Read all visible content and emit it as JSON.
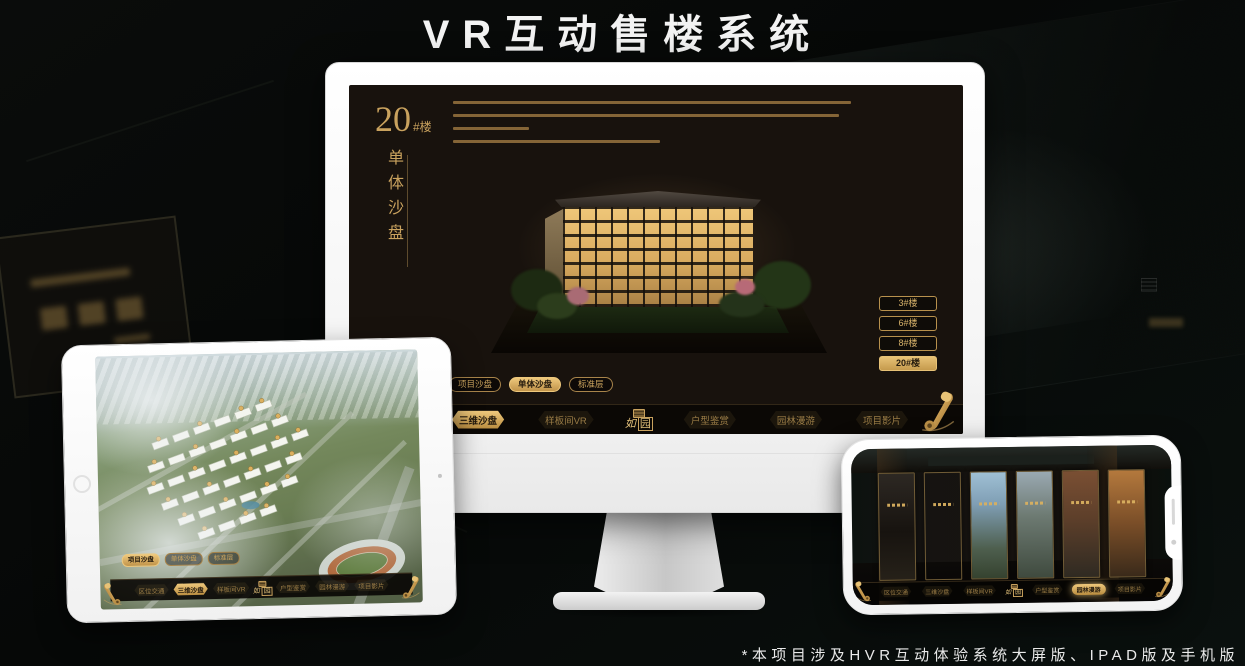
{
  "page": {
    "title": "VR互动售楼系统",
    "footnote": "*本项目涉及HVR互动体验系统大屏版、IPAD版及手机版"
  },
  "colors": {
    "gold": "#d2ab64",
    "gold_selected_bg": "#eec87c",
    "screen_bg": "#18120d",
    "nav_bg": "#0b0805"
  },
  "monitor": {
    "headline": {
      "number": "20",
      "suffix": "#楼",
      "subtitle": "单体沙盘"
    },
    "tabs": [
      {
        "label": "项目沙盘",
        "selected": false
      },
      {
        "label": "单体沙盘",
        "selected": true
      },
      {
        "label": "标准层",
        "selected": false
      }
    ],
    "floor_buttons": [
      {
        "label": "3#楼",
        "selected": false
      },
      {
        "label": "6#楼",
        "selected": false
      },
      {
        "label": "8#楼",
        "selected": false
      },
      {
        "label": "20#楼",
        "selected": true
      }
    ],
    "nav": {
      "items": [
        "区位交通",
        "三维沙盘",
        "样板间VR",
        "户型鉴赏",
        "园林漫游",
        "项目影片"
      ],
      "selected": "三维沙盘",
      "logo": {
        "script": "如",
        "boxed": "园"
      }
    }
  },
  "tablet": {
    "tabs": [
      {
        "label": "项目沙盘",
        "selected": true
      },
      {
        "label": "单体沙盘",
        "selected": false
      },
      {
        "label": "标准层",
        "selected": false
      }
    ],
    "nav": {
      "items": [
        "区位交通",
        "三维沙盘",
        "样板间VR",
        "户型鉴赏",
        "园林漫游",
        "项目影片"
      ],
      "selected": "三维沙盘",
      "logo": {
        "script": "如",
        "boxed": "园"
      }
    }
  },
  "phone": {
    "nav": {
      "items": [
        "区位交通",
        "三维沙盘",
        "样板间VR",
        "户型鉴赏",
        "园林漫游",
        "项目影片"
      ],
      "selected": "园林漫游",
      "logo": {
        "script": "如",
        "boxed": "园"
      }
    },
    "panels": [
      {
        "gradient": "linear-gradient(180deg,#2d2823,#17130f 55%,#262119)"
      },
      {
        "gradient": "linear-gradient(180deg,#51473a,#2e2822 60%,#42362а)"
      },
      {
        "gradient": "linear-gradient(180deg,#9fc0d4 0%,#7f9eb4 30%,#4e5f4e 72%,#35422f)"
      },
      {
        "gradient": "linear-gradient(180deg,#9aa9b2 0%,#6d7a72 42%,#3f4a3e)"
      },
      {
        "gradient": "linear-gradient(180deg,#7a4f33 0%,#5d3f2a 45%,#2f2a22)"
      },
      {
        "gradient": "linear-gradient(180deg,#b4793d 0%,#7a4e28 50%,#3a2a1a)"
      }
    ]
  }
}
